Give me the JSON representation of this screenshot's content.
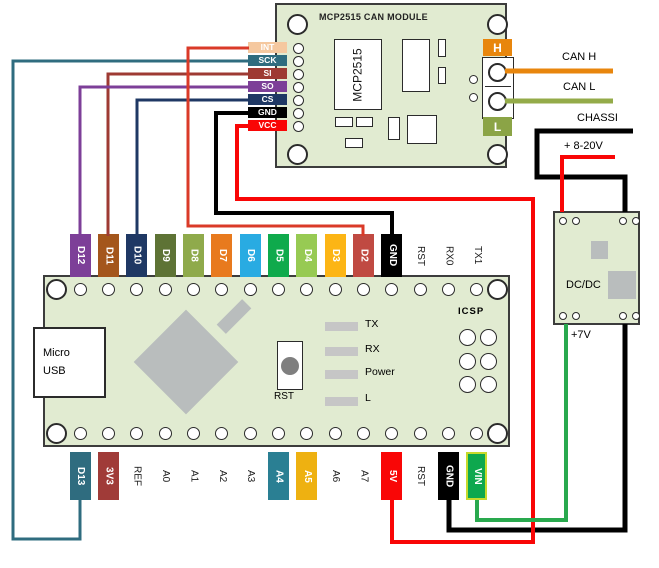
{
  "colors": {
    "board_green": "#e1ebd1",
    "component_gray": "#b9bdbd",
    "led_gray": "#c6c6c6",
    "button_gray": "#7f7f7f"
  },
  "mcp_module": {
    "title": "MCP2515 CAN MODULE",
    "ic_label": "MCP2515",
    "h_label": "H",
    "h_bg": "#e8860d",
    "l_label": "L",
    "l_bg": "#8ba446",
    "pins": [
      {
        "label": "INT",
        "bg": "#f5c89f"
      },
      {
        "label": "SCK",
        "bg": "#2f6c7f"
      },
      {
        "label": "SI",
        "bg": "#9e3a33"
      },
      {
        "label": "SO",
        "bg": "#7d3f98"
      },
      {
        "label": "CS",
        "bg": "#1f3864"
      },
      {
        "label": "GND",
        "bg": "#000000"
      },
      {
        "label": "VCC",
        "bg": "#f90606"
      }
    ]
  },
  "nano": {
    "usb_line1": "Micro",
    "usb_line2": "USB",
    "rst_label": "RST",
    "icsp_label": "ICSP",
    "led_labels": [
      "TX",
      "RX",
      "Power",
      "L"
    ],
    "top_pins": [
      {
        "label": "D12",
        "bg": "#7d3f98"
      },
      {
        "label": "D11",
        "bg": "#a4561c"
      },
      {
        "label": "D10",
        "bg": "#1f3864"
      },
      {
        "label": "D9",
        "bg": "#5e7335"
      },
      {
        "label": "D8",
        "bg": "#8faa4b"
      },
      {
        "label": "D7",
        "bg": "#e87a1e"
      },
      {
        "label": "D6",
        "bg": "#29abe2"
      },
      {
        "label": "D5",
        "bg": "#0faa4c"
      },
      {
        "label": "D4",
        "bg": "#97ca53"
      },
      {
        "label": "D3",
        "bg": "#fcb515"
      },
      {
        "label": "D2",
        "bg": "#c04a42"
      },
      {
        "label": "GND",
        "bg": "#000000"
      },
      {
        "label": "RST",
        "bg": null
      },
      {
        "label": "RX0",
        "bg": null
      },
      {
        "label": "TX1",
        "bg": null
      }
    ],
    "bottom_pins": [
      {
        "label": "D13",
        "bg": "#2f6c7f"
      },
      {
        "label": "3V3",
        "bg": "#a03b38"
      },
      {
        "label": "REF",
        "bg": null
      },
      {
        "label": "A0",
        "bg": null
      },
      {
        "label": "A1",
        "bg": null
      },
      {
        "label": "A2",
        "bg": null
      },
      {
        "label": "A3",
        "bg": null
      },
      {
        "label": "A4",
        "bg": "#2a7f93"
      },
      {
        "label": "A5",
        "bg": "#eeb111"
      },
      {
        "label": "A6",
        "bg": null
      },
      {
        "label": "A7",
        "bg": null
      },
      {
        "label": "5V",
        "bg": "#f90606"
      },
      {
        "label": "RST",
        "bg": null
      },
      {
        "label": "GND",
        "bg": "#000000"
      },
      {
        "label": "VIN",
        "bg": "#0ea84e",
        "border": "#c7da2c"
      }
    ]
  },
  "dcdc": {
    "label": "DC/DC",
    "output_label": "+7V"
  },
  "annotations": {
    "can_h": "CAN H",
    "can_l": "CAN L",
    "chassis": "CHASSI",
    "power_in": "+ 8-20V"
  },
  "wires": [
    {
      "name": "sck-to-d13",
      "color": "#2f6c7f",
      "width": 3,
      "points": [
        [
          249,
          61
        ],
        [
          13,
          61
        ],
        [
          13,
          539
        ],
        [
          80,
          539
        ],
        [
          80,
          500
        ]
      ]
    },
    {
      "name": "si-to-d11",
      "color": "#9e3a33",
      "width": 3,
      "points": [
        [
          249,
          74
        ],
        [
          108,
          74
        ],
        [
          108,
          236
        ]
      ]
    },
    {
      "name": "so-to-d12",
      "color": "#7d3f98",
      "width": 3,
      "points": [
        [
          249,
          87
        ],
        [
          80,
          87
        ],
        [
          80,
          236
        ]
      ]
    },
    {
      "name": "cs-to-d10",
      "color": "#1f3864",
      "width": 3,
      "points": [
        [
          249,
          100
        ],
        [
          137,
          100
        ],
        [
          137,
          236
        ]
      ]
    },
    {
      "name": "can-h",
      "color": "#e8860d",
      "width": 5,
      "points": [
        [
          505,
          71
        ],
        [
          613,
          71
        ]
      ]
    },
    {
      "name": "can-l",
      "color": "#94ab49",
      "width": 5,
      "points": [
        [
          505,
          101
        ],
        [
          613,
          101
        ]
      ]
    },
    {
      "name": "chassis-in",
      "color": "#000000",
      "width": 5,
      "points": [
        [
          633,
          131
        ],
        [
          537,
          131
        ],
        [
          537,
          177
        ],
        [
          625,
          177
        ],
        [
          625,
          212
        ]
      ]
    },
    {
      "name": "dcdc-gnd-to-nano-gnd",
      "color": "#000000",
      "width": 5,
      "points": [
        [
          625,
          324
        ],
        [
          625,
          530
        ],
        [
          449,
          530
        ],
        [
          449,
          500
        ]
      ]
    },
    {
      "name": "gnd-to-nano-gnd-top",
      "color": "#000000",
      "width": 4,
      "points": [
        [
          249,
          113
        ],
        [
          216,
          113
        ],
        [
          216,
          213
        ],
        [
          392,
          213
        ],
        [
          392,
          236
        ]
      ]
    },
    {
      "name": "int-to-d2",
      "color": "#da3a28",
      "width": 3,
      "points": [
        [
          249,
          48
        ],
        [
          188,
          48
        ],
        [
          188,
          226
        ],
        [
          363,
          226
        ],
        [
          363,
          236
        ]
      ]
    },
    {
      "name": "power-in-8-20v",
      "color": "#f90606",
      "width": 4,
      "points": [
        [
          615,
          157
        ],
        [
          562,
          157
        ],
        [
          562,
          212
        ]
      ]
    },
    {
      "name": "vcc-to-5v",
      "color": "#f90606",
      "width": 4,
      "points": [
        [
          249,
          126
        ],
        [
          237,
          126
        ],
        [
          237,
          199
        ],
        [
          533,
          199
        ],
        [
          533,
          542
        ],
        [
          392,
          542
        ],
        [
          392,
          500
        ]
      ]
    },
    {
      "name": "dcdc-7v-to-vin",
      "color": "#29a94e",
      "width": 4,
      "points": [
        [
          566,
          324
        ],
        [
          566,
          520
        ],
        [
          477,
          520
        ],
        [
          477,
          500
        ]
      ]
    }
  ]
}
